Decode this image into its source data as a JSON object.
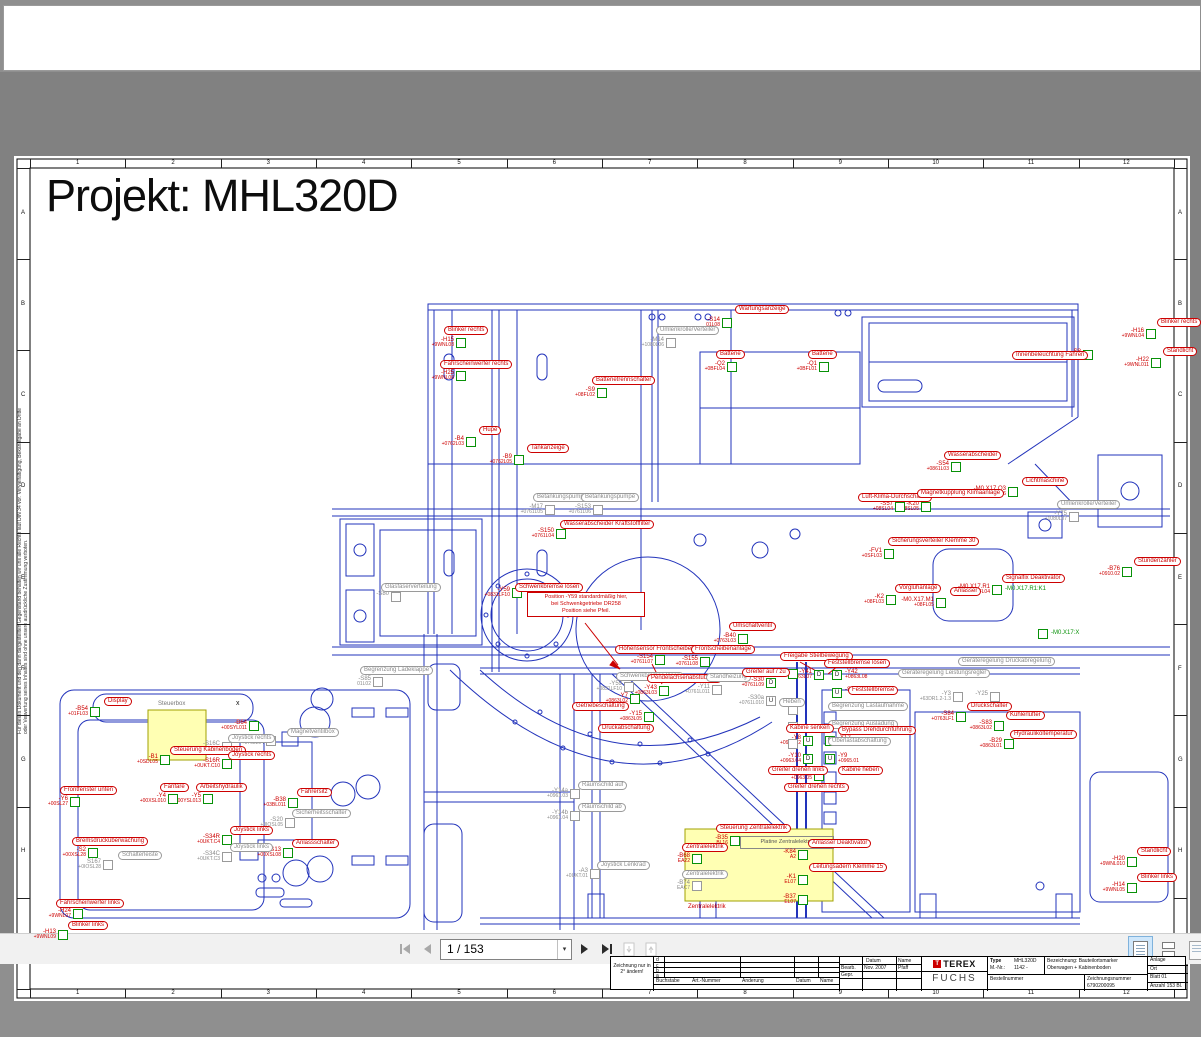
{
  "colors": {
    "blue": "#2233bb",
    "red": "#cc0000",
    "green": "#089108",
    "gray": "#8a8a8a",
    "yellow": "#ffffb3",
    "toolbar_active": "#cfe7fb"
  },
  "toolbar": {
    "page_indicator": "1 / 153",
    "first_page": "first-page",
    "prev_page": "previous-page",
    "next_page": "next-page",
    "last_page": "last-page",
    "caret": "▾"
  },
  "page": {
    "title": "Projekt: MHL320D",
    "side_note": "Für dieses Dokument und den darin dargestellten Gegenstand behalten wir uns alle Rechte laut DIN 34 vor. Vervielfältigung, Bekanntgabe an Dritte oder Verwertung seines Inhaltes sind ohne unsere ausdrückliche Zustimmung verboten.",
    "frame": {
      "cols": [
        "1",
        "2",
        "3",
        "4",
        "5",
        "6",
        "7",
        "8",
        "9",
        "10",
        "11",
        "12"
      ],
      "rows": [
        "A",
        "B",
        "C",
        "D",
        "E",
        "F",
        "G",
        "H",
        "I"
      ]
    },
    "captions": {
      "steuerbox": "Steuerbox",
      "platine": "Platine Zentralelektrik",
      "zentralelektrik": "Zentralelektrik",
      "x_mark": "x"
    },
    "note_box": [
      "Position -Y59 standardmäßig hier,",
      "bei Schwenkgetriebe DR258",
      "Position siehe Pfeil."
    ],
    "markers": [
      {
        "x": 722,
        "y": 246,
        "t": "-S14",
        "s": "01L08",
        "l": "Wartungsanzeige",
        "lx": 735,
        "ly": 233,
        "c": "red"
      },
      {
        "x": 1146,
        "y": 257,
        "t": "-H16",
        "s": "+9WNL04",
        "l": "Blinker rechts",
        "lx": 1157,
        "ly": 246,
        "c": "red"
      },
      {
        "x": 1151,
        "y": 286,
        "t": "-H22",
        "s": "+9WNL011",
        "l": "Standlicht",
        "lx": 1163,
        "ly": 275,
        "c": "red"
      },
      {
        "x": 1083,
        "y": 278,
        "t": "-S8",
        "s": "+08SL04",
        "l": "Innenbeleuchtung Fahren",
        "lx": 1012,
        "ly": 279,
        "c": "red"
      },
      {
        "x": 456,
        "y": 266,
        "t": "-H15",
        "s": "+9WNL08",
        "l": "Blinker rechts",
        "lx": 444,
        "ly": 254,
        "c": "red"
      },
      {
        "x": 456,
        "y": 299,
        "t": "-H25",
        "s": "+9WNL06",
        "l": "Fahrscheinwerfer rechts",
        "lx": 440,
        "ly": 288,
        "c": "red"
      },
      {
        "x": 466,
        "y": 365,
        "t": "-B4",
        "s": "+0762L03",
        "l": "Hupe",
        "lx": 479,
        "ly": 354,
        "c": "red"
      },
      {
        "x": 514,
        "y": 383,
        "t": "-B9",
        "s": "+0762L05",
        "l": "Tankanzeige",
        "lx": 527,
        "ly": 372,
        "c": "red"
      },
      {
        "x": 597,
        "y": 316,
        "t": "-S9",
        "s": "+08FL02",
        "l": "Batterietrennschalter",
        "lx": 592,
        "ly": 304,
        "c": "red"
      },
      {
        "x": 727,
        "y": 290,
        "t": "-Q2",
        "s": "+0BFL04",
        "l": "Batterie",
        "lx": 716,
        "ly": 278,
        "c": "red"
      },
      {
        "x": 819,
        "y": 290,
        "t": "-Q1",
        "s": "+0BFL01",
        "l": "Batterie",
        "lx": 808,
        "ly": 278,
        "c": "red"
      },
      {
        "x": 666,
        "y": 266,
        "t": "-M14",
        "s": "+1080L06",
        "l": "Umlenkrolle/Verteiler",
        "lx": 656,
        "ly": 254,
        "c": "gray"
      },
      {
        "x": 1069,
        "y": 440,
        "t": "-Y75",
        "s": "+1080L07",
        "l": "Umlenkrolle/Verteiler",
        "lx": 1057,
        "ly": 428,
        "c": "gray"
      },
      {
        "x": 545,
        "y": 433,
        "t": "-M17",
        "s": "+0761L05",
        "l": "Betankungspumpe",
        "lx": 533,
        "ly": 421,
        "c": "gray"
      },
      {
        "x": 593,
        "y": 433,
        "t": "-S153",
        "s": "+0761L06",
        "l": "Betankungspumpe",
        "lx": 581,
        "ly": 421,
        "c": "gray"
      },
      {
        "x": 556,
        "y": 457,
        "t": "-S150",
        "s": "+0761L04",
        "l": "Wasserabscheider Kraftstofffilter",
        "lx": 560,
        "ly": 448,
        "c": "red"
      },
      {
        "x": 512,
        "y": 516,
        "t": "-Y59",
        "s": "+0831LF10",
        "l": "Schwenkbremse lösen",
        "lx": 515,
        "ly": 511,
        "c": "red"
      },
      {
        "x": 391,
        "y": 520,
        "t": "-S80",
        "s": "",
        "l": "Glasfaserverteilung",
        "lx": 381,
        "ly": 511,
        "c": "gray"
      },
      {
        "x": 951,
        "y": 390,
        "t": "-S54",
        "s": "+0861L03",
        "l": "Wasserabscheider",
        "lx": 944,
        "ly": 379,
        "c": "red"
      },
      {
        "x": 1008,
        "y": 415,
        "t": "-M0.X17.Q3",
        "s": "+08FL06",
        "l": "Lichtmaschine",
        "lx": 1022,
        "ly": 405,
        "c": "red"
      },
      {
        "x": 895,
        "y": 430,
        "t": "-S57",
        "s": "+08SL04",
        "l": "Luft-Klima-Durchschalter",
        "lx": 858,
        "ly": 421,
        "c": "red"
      },
      {
        "x": 921,
        "y": 430,
        "t": "-K20",
        "s": "+08SL05",
        "l": "Magnetkupplung Klimaanlage",
        "lx": 917,
        "ly": 417,
        "c": "red"
      },
      {
        "x": 884,
        "y": 477,
        "t": "-FV1",
        "s": "+0SFL03",
        "l": "Sicherungsverteiler Klemme 30",
        "lx": 888,
        "ly": 465,
        "c": "red"
      },
      {
        "x": 886,
        "y": 523,
        "t": "-K2",
        "s": "+08FL03",
        "l": "Vorglühanlage",
        "lx": 895,
        "ly": 512,
        "c": "red"
      },
      {
        "x": 936,
        "y": 526,
        "t": "-M0.X17.M1",
        "s": "+08FL05",
        "l": "Anlasser",
        "lx": 950,
        "ly": 515,
        "c": "red"
      },
      {
        "x": 992,
        "y": 513,
        "t": "-M0.X17.R1",
        "s": "+08FL04",
        "l": "Signalfix Deaktivator",
        "lx": 1002,
        "ly": 502,
        "c": "red",
        "g": "-M0.X17.R1:K1"
      },
      {
        "x": 1122,
        "y": 495,
        "t": "-B76",
        "s": "+0910.02",
        "l": "Stundenzähler",
        "lx": 1134,
        "ly": 485,
        "c": "red"
      },
      {
        "x": 1038,
        "y": 557,
        "t": "",
        "s": "",
        "l": "-M0.X17:X",
        "c": "green"
      },
      {
        "x": 738,
        "y": 562,
        "t": "-B40",
        "s": "+0763L03",
        "l": "Umschaltventil",
        "lx": 729,
        "ly": 550,
        "c": "red"
      },
      {
        "x": 655,
        "y": 583,
        "t": "-S154",
        "s": "+0761L07",
        "l": "Höhensensor Frontscheibenanlage",
        "lx": 615,
        "ly": 573,
        "c": "red"
      },
      {
        "x": 700,
        "y": 585,
        "t": "-S155",
        "s": "+0761L08",
        "l": "Frontscheibenanlage",
        "lx": 691,
        "ly": 573,
        "c": "red"
      },
      {
        "x": 788,
        "y": 597,
        "t": "-Y44",
        "s": "+0863L04",
        "l": "Freigabe Stielbewegung",
        "lx": 780,
        "ly": 580,
        "c": "red"
      },
      {
        "x": 624,
        "y": 610,
        "t": "-Y59",
        "s": "+0831LF10",
        "l": "Schwenkbremse lösen",
        "lx": 616,
        "ly": 600,
        "c": "gray"
      },
      {
        "x": 659,
        "y": 614,
        "t": "-Y43",
        "s": "+0863L03",
        "l": "Pendelachsenabstützung",
        "lx": 647,
        "ly": 602,
        "c": "red"
      },
      {
        "x": 630,
        "y": 622,
        "t": "-Y7",
        "s": "+0863L02",
        "l": "Getriebeschaltung",
        "lx": 572,
        "ly": 630,
        "c": "red"
      },
      {
        "x": 644,
        "y": 640,
        "t": "-Y15",
        "s": "+0863L05",
        "l": "Druckabschaltung",
        "lx": 598,
        "ly": 652,
        "c": "red"
      },
      {
        "x": 712,
        "y": 613,
        "t": "-Y11",
        "s": "+0761L011",
        "l": "Standheizung",
        "lx": 706,
        "ly": 601,
        "c": "gray"
      },
      {
        "x": 373,
        "y": 605,
        "t": "-S85",
        "s": "01L02",
        "l": "Begrenzung Ladeklappe",
        "lx": 360,
        "ly": 594,
        "c": "gray"
      },
      {
        "x": 766,
        "y": 606,
        "t": "-S30",
        "s": "+0761L09",
        "l": "Greifer auf / zu",
        "lx": 742,
        "ly": 596,
        "c": "red",
        "L": "D"
      },
      {
        "x": 766,
        "y": 624,
        "t": "-S30a",
        "s": "+0761L010",
        "l": "Heben",
        "lx": 779,
        "ly": 626,
        "c": "gray",
        "L": "U"
      },
      {
        "x": 814,
        "y": 598,
        "t": "-Y41",
        "s": "+0863L07",
        "l": "Feststellbremse lösen",
        "lx": 824,
        "ly": 587,
        "c": "red",
        "L": "D"
      },
      {
        "x": 832,
        "y": 598,
        "t": "-Y42",
        "s": "+0863L08",
        "l": "",
        "c": "red",
        "L": "D",
        "r": 1
      },
      {
        "x": 832,
        "y": 616,
        "t": "-S6",
        "s": "",
        "l": "Feststellbremse",
        "lx": 848,
        "ly": 614,
        "c": "red",
        "L": "U",
        "r": 1
      },
      {
        "x": 788,
        "y": 633,
        "t": "",
        "s": "",
        "l": "Begrenzung Lastaufnahme",
        "lx": 828,
        "ly": 630,
        "c": "gray"
      },
      {
        "x": 788,
        "y": 650,
        "t": "",
        "s": "",
        "l": "Begrenzung Ausladung",
        "lx": 828,
        "ly": 648,
        "c": "gray"
      },
      {
        "x": 788,
        "y": 667,
        "t": "",
        "s": "",
        "l": "Überlastabschaltung",
        "lx": 828,
        "ly": 665,
        "c": "gray"
      },
      {
        "x": 956,
        "y": 640,
        "t": "-S84",
        "s": "+0763LF1",
        "l": "Druckschalter",
        "lx": 967,
        "ly": 630,
        "c": "red"
      },
      {
        "x": 953,
        "y": 620,
        "t": "-Y3",
        "s": "+63DR1.2-1.3",
        "l": "Geräteregelung Leistungsregler",
        "lx": 898,
        "ly": 597,
        "c": "gray"
      },
      {
        "x": 990,
        "y": 620,
        "t": "-Y25",
        "s": "",
        "l": "Geräteregelung Druckabregelung",
        "lx": 958,
        "ly": 585,
        "c": "gray"
      },
      {
        "x": 994,
        "y": 649,
        "t": "-S83",
        "s": "+0863L02",
        "l": "Kühlerlüfter",
        "lx": 1006,
        "ly": 639,
        "c": "red"
      },
      {
        "x": 1004,
        "y": 667,
        "t": "-B29",
        "s": "+0863L01",
        "l": "Hydrauliköltemperatur",
        "lx": 1010,
        "ly": 658,
        "c": "red"
      },
      {
        "x": 803,
        "y": 664,
        "t": "-Y8",
        "s": "+0965.02",
        "l": "Kabine senken",
        "lx": 786,
        "ly": 652,
        "c": "red",
        "L": "U"
      },
      {
        "x": 825,
        "y": 664,
        "t": "-Y12",
        "s": "+0963.08",
        "l": "Bypass Drehdurchführung",
        "lx": 838,
        "ly": 654,
        "c": "red",
        "L": "D",
        "r": 1
      },
      {
        "x": 803,
        "y": 682,
        "t": "-Y10",
        "s": "+0963.04",
        "l": "Greifer drehen links",
        "lx": 768,
        "ly": 694,
        "c": "red",
        "L": "D"
      },
      {
        "x": 825,
        "y": 682,
        "t": "-Y9",
        "s": "+0965.01",
        "l": "Kabine heben",
        "lx": 838,
        "ly": 694,
        "c": "red",
        "L": "U",
        "r": 1
      },
      {
        "x": 814,
        "y": 699,
        "t": "-Y13",
        "s": "+0963.05",
        "l": "Greifer drehen rechts",
        "lx": 784,
        "ly": 711,
        "c": "red"
      },
      {
        "x": 570,
        "y": 717,
        "t": "-Y14a",
        "s": "+0961.03",
        "l": "Räumschild auf",
        "lx": 578,
        "ly": 709,
        "c": "gray"
      },
      {
        "x": 570,
        "y": 739,
        "t": "-Y14b",
        "s": "+0961.04",
        "l": "Räumschild ab",
        "lx": 578,
        "ly": 731,
        "c": "gray"
      },
      {
        "x": 590,
        "y": 797,
        "t": "-A3",
        "s": "+0UKT.01",
        "l": "Joystick Lenkrad",
        "lx": 597,
        "ly": 789,
        "c": "gray"
      },
      {
        "x": 730,
        "y": 764,
        "t": "-B35",
        "s": "BL16",
        "l": "Steuerung Zentralelektrik",
        "lx": 716,
        "ly": 752,
        "c": "red"
      },
      {
        "x": 692,
        "y": 782,
        "t": "-B68",
        "s": "EA22",
        "l": "Zentralelektrik",
        "lx": 682,
        "ly": 771,
        "c": "red"
      },
      {
        "x": 692,
        "y": 809,
        "t": "-B74",
        "s": "EAC7",
        "l": "Zentralelektrik",
        "lx": 682,
        "ly": 798,
        "c": "gray"
      },
      {
        "x": 798,
        "y": 778,
        "t": "-K84",
        "s": "A2",
        "l": "Anlasser Deaktivator",
        "lx": 808,
        "ly": 767,
        "c": "red"
      },
      {
        "x": 798,
        "y": 803,
        "t": "-K1",
        "s": "EL07",
        "l": "Leitungsadern Klemme 15",
        "lx": 809,
        "ly": 791,
        "c": "red"
      },
      {
        "x": 798,
        "y": 823,
        "t": "-B37",
        "s": "EL07",
        "l": "",
        "c": "red"
      },
      {
        "x": 1127,
        "y": 785,
        "t": "-H20",
        "s": "+9WNL010",
        "l": "Standlicht",
        "lx": 1137,
        "ly": 775,
        "c": "red"
      },
      {
        "x": 1127,
        "y": 811,
        "t": "-H14",
        "s": "+9WNL05",
        "l": "Blinker links",
        "lx": 1137,
        "ly": 801,
        "c": "red"
      },
      {
        "x": 90,
        "y": 635,
        "t": "-B54",
        "s": "+01FL03",
        "l": "Display",
        "lx": 104,
        "ly": 625,
        "c": "red"
      },
      {
        "x": 160,
        "y": 683,
        "t": "-B1",
        "s": "+0SDL05",
        "l": "Steuerung Kabinenboden",
        "lx": 170,
        "ly": 674,
        "c": "red"
      },
      {
        "x": 249,
        "y": 649,
        "t": "-B64",
        "s": "+00SYL011",
        "l": "",
        "c": "red"
      },
      {
        "x": 222,
        "y": 670,
        "t": "-S16C",
        "s": "+0UKT.02",
        "l": "Joystick rechts",
        "lx": 228,
        "ly": 662,
        "c": "gray"
      },
      {
        "x": 222,
        "y": 687,
        "t": "-S16R",
        "s": "+0UKT.C10",
        "l": "Joystick rechts",
        "lx": 228,
        "ly": 679,
        "c": "red"
      },
      {
        "x": 266,
        "y": 664,
        "t": "-B55",
        "s": "+0768L04",
        "l": "Magnetventilbox",
        "lx": 287,
        "ly": 656,
        "c": "gray"
      },
      {
        "x": 168,
        "y": 722,
        "t": "-Y4",
        "s": "+00XSL010",
        "l": "Fanfare",
        "lx": 160,
        "ly": 711,
        "c": "red"
      },
      {
        "x": 203,
        "y": 722,
        "t": "-Y5",
        "s": "+00YSL013",
        "l": "Arbeitshydraulik",
        "lx": 196,
        "ly": 711,
        "c": "red"
      },
      {
        "x": 288,
        "y": 726,
        "t": "-B38",
        "s": "+03BL011",
        "l": "Fahrersitz",
        "lx": 297,
        "ly": 716,
        "c": "red"
      },
      {
        "x": 285,
        "y": 746,
        "t": "-S20",
        "s": "+0IOSL05",
        "l": "Sicherheitsschalter",
        "lx": 292,
        "ly": 737,
        "c": "gray"
      },
      {
        "x": 222,
        "y": 763,
        "t": "-S34R",
        "s": "+0UKT.C4",
        "l": "Joystick links",
        "lx": 230,
        "ly": 754,
        "c": "red"
      },
      {
        "x": 222,
        "y": 780,
        "t": "-S34C",
        "s": "+0UKT.C3",
        "l": "Joystick links",
        "lx": 230,
        "ly": 771,
        "c": "gray"
      },
      {
        "x": 283,
        "y": 776,
        "t": "-S13",
        "s": "+00XSL08",
        "l": "Anlassschalter",
        "lx": 292,
        "ly": 767,
        "c": "red"
      },
      {
        "x": 88,
        "y": 776,
        "t": "-S2",
        "s": "+00XSL28",
        "l": "Bremsdrucküberwachung",
        "lx": 72,
        "ly": 765,
        "c": "red"
      },
      {
        "x": 103,
        "y": 788,
        "t": "S167",
        "s": "+0IOSL28",
        "l": "Schalterleiste",
        "lx": 118,
        "ly": 779,
        "c": "gray"
      },
      {
        "x": 70,
        "y": 725,
        "t": "-Y6",
        "s": "+00SL27",
        "l": "Frontfenster unten",
        "lx": 60,
        "ly": 714,
        "c": "red"
      },
      {
        "x": 73,
        "y": 837,
        "t": "-H24",
        "s": "+9WNL07",
        "l": "Fahrscheinwerfer links",
        "lx": 56,
        "ly": 827,
        "c": "red"
      },
      {
        "x": 58,
        "y": 858,
        "t": "-H13",
        "s": "+9WNL09",
        "l": "Blinker links",
        "lx": 68,
        "ly": 849,
        "c": "red"
      }
    ],
    "titleblock": {
      "change_note": "Zeichnung nur in 2° ändern!",
      "rev_rows": [
        "d",
        "c",
        "b",
        "a"
      ],
      "rev_headers": [
        "Buchstabe",
        "Art.-Nummer",
        "Änderung",
        "Datum",
        "Name"
      ],
      "sig_headers": [
        "Datum",
        "Name"
      ],
      "sig_rows": [
        {
          "role": "Bearb.",
          "date": "Nov. 2007",
          "name": "Pfaff"
        },
        {
          "role": "Gepr.",
          "date": "",
          "name": ""
        }
      ],
      "brand_top": "TEREX",
      "brand_bottom": "FUCHS",
      "brand_glyph": "T",
      "type_label": "Type",
      "type_value": "MHL320D",
      "mnr_label": "M.-Nr.:",
      "mnr_value": "1142 -",
      "bez_label": "Bezeichnung: Bauteilortsmarker",
      "bez_value2": "Oberwagen + Kabinenboden",
      "bestell_label": "Bestellnummer",
      "zeich_label": "Zeichnungsnummer",
      "zeich_value": "6790200095",
      "anlage": "Anlage",
      "ort": "Ort",
      "blatt": "Blatt  01",
      "anzahl": "Anzahl 153 Bl."
    }
  }
}
